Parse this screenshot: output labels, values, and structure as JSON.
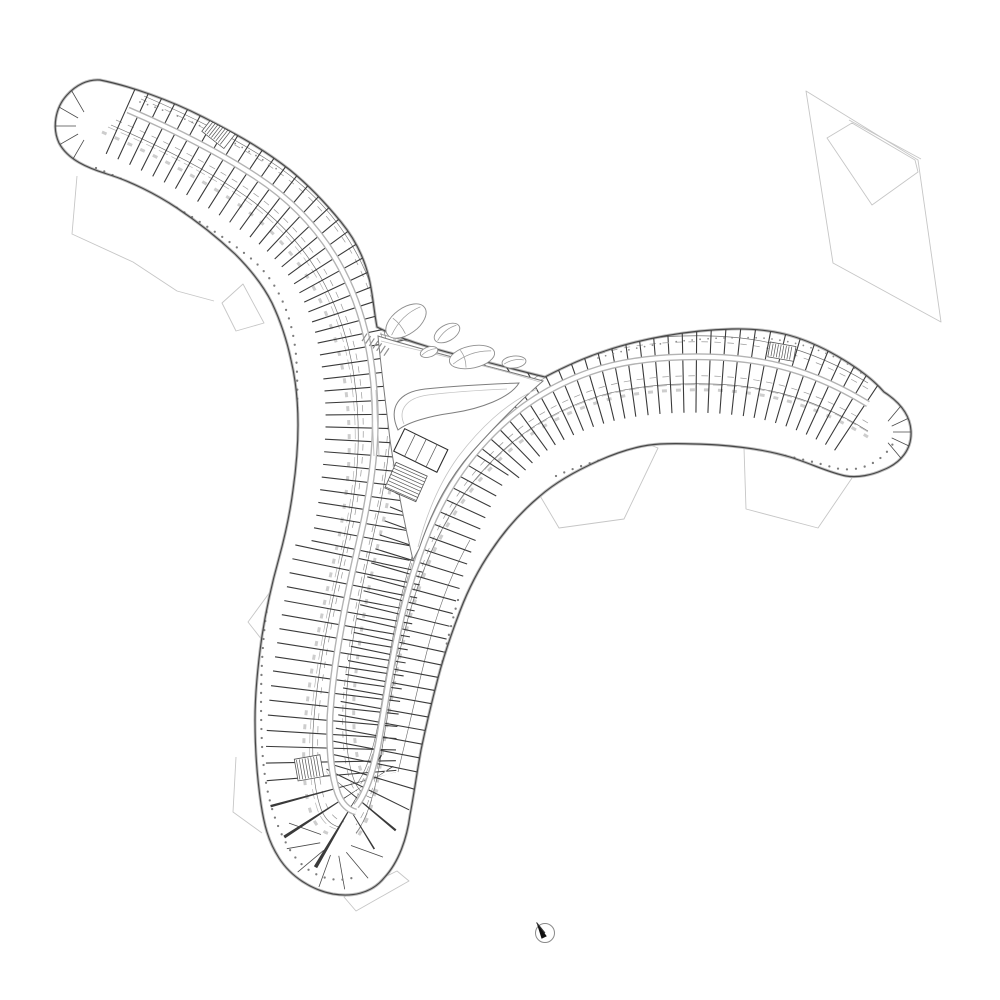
{
  "meta": {
    "title": "Y-shaped building floor plan",
    "description": "Architectural floor plan of a three-winged (Y-shaped) residential building with curved double-loaded wings of small rooms, rounded wing tips, a central courtyard with stair, pond and leaf-shaped planters, faint site/terrace boundary outlines, a detached site parcel at the top right, and a north arrow symbol at the bottom."
  },
  "canvas": {
    "width": 1000,
    "height": 1000,
    "background": "#ffffff"
  },
  "colors": {
    "outline": "#474747",
    "outline_halo": "#bdbdbd",
    "wall_tick": "#3a3a3a",
    "corridor": "#b3b3b3",
    "room_line": "#6f6f6f",
    "furniture": "#9a9a9a",
    "counter": "#cdcdcd",
    "dots": "#7d7d7d",
    "site": "#c6c6c6",
    "leaf": "#8f8f8f",
    "north_needle": "#111111"
  },
  "elements": {
    "wings": 3,
    "wing_tips": [
      "upper-left",
      "right",
      "bottom"
    ],
    "leaf_planters": 5,
    "stairs": 4,
    "site_outline_fragments": 7,
    "detached_parcel": "quadrilateral with inner pentagon, top right",
    "north_arrow": "circle with needle pointing north-west"
  }
}
